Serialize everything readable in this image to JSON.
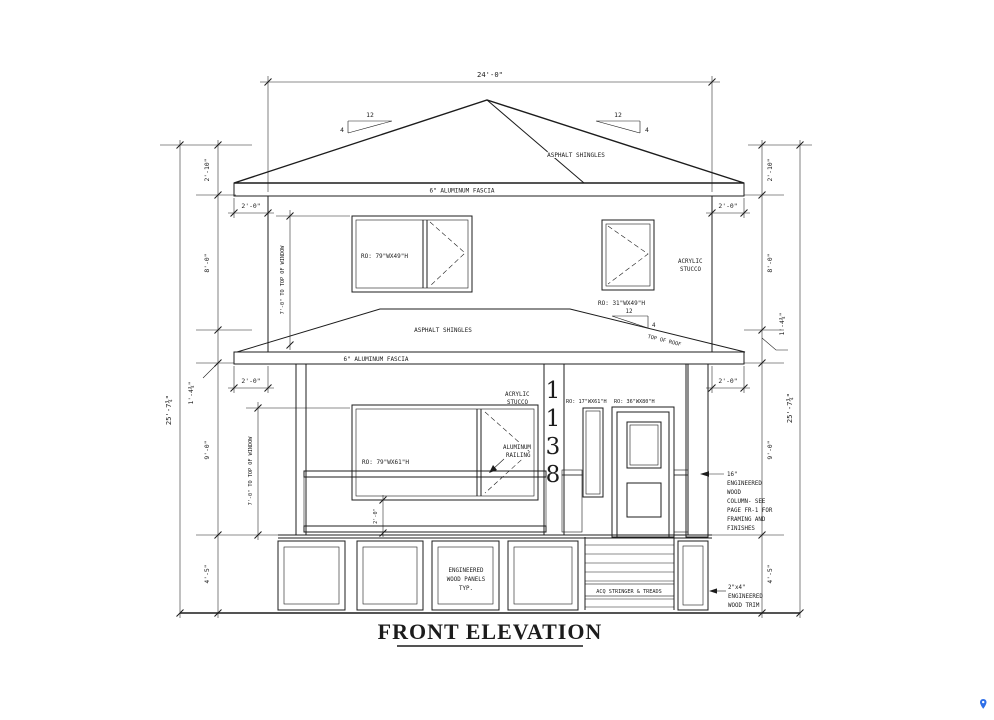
{
  "page": {
    "background": "#ffffff",
    "line_color": "#1c1c1c",
    "watermark_color": "#2f6fe8"
  },
  "title": "FRONT ELEVATION",
  "house_number": {
    "digits": [
      "1",
      "1",
      "3",
      "8"
    ]
  },
  "roof": {
    "asphalt_shingles": "ASPHALT SHINGLES",
    "fascia": "6\" ALUMINUM FASCIA",
    "pitch_run": "12",
    "pitch_rise": "4",
    "top_of_roof": "TOP OF ROOF"
  },
  "wall": {
    "acrylic": "ACRYLIC",
    "stucco": "STUCCO"
  },
  "windows": {
    "upper_left_ro": "RO: 79\"WX49\"H",
    "upper_right_ro": "RO: 31\"WX49\"H",
    "main_ro": "RO: 79\"WX61\"H",
    "side_ro": "RO: 17\"WX61\"H",
    "door_ro": "RO: 36\"WX80\"H"
  },
  "railing": {
    "line1": "ALUMINUM",
    "line2": "RAILING"
  },
  "column_note": {
    "lines": [
      "16\"",
      "ENGINEERED",
      "WOOD",
      "COLUMN- SEE",
      "PAGE FR-1 FOR",
      "FRAMING AND",
      "FINISHES"
    ]
  },
  "trim_note": {
    "lines": [
      "2\"x4\"",
      "ENGINEERED",
      "WOOD TRIM"
    ]
  },
  "panels_note": {
    "lines": [
      "ENGINEERED",
      "WOOD PANELS",
      "TYP."
    ]
  },
  "stairs_note": "ACQ STRINGER & TREADS",
  "dims": {
    "overall_width": "24'-0\"",
    "overall_height": "25'-7¾\"",
    "roof_height": "2'-10\"",
    "upper_wall": "8'-0\"",
    "band": "1'-4¾\"",
    "main_wall": "9'-0\"",
    "foundation": "4'-5\"",
    "overhang": "2'-0\"",
    "window_head": "7'-0\" TO TOP OF WINDOW",
    "sill": "2'-0\""
  }
}
